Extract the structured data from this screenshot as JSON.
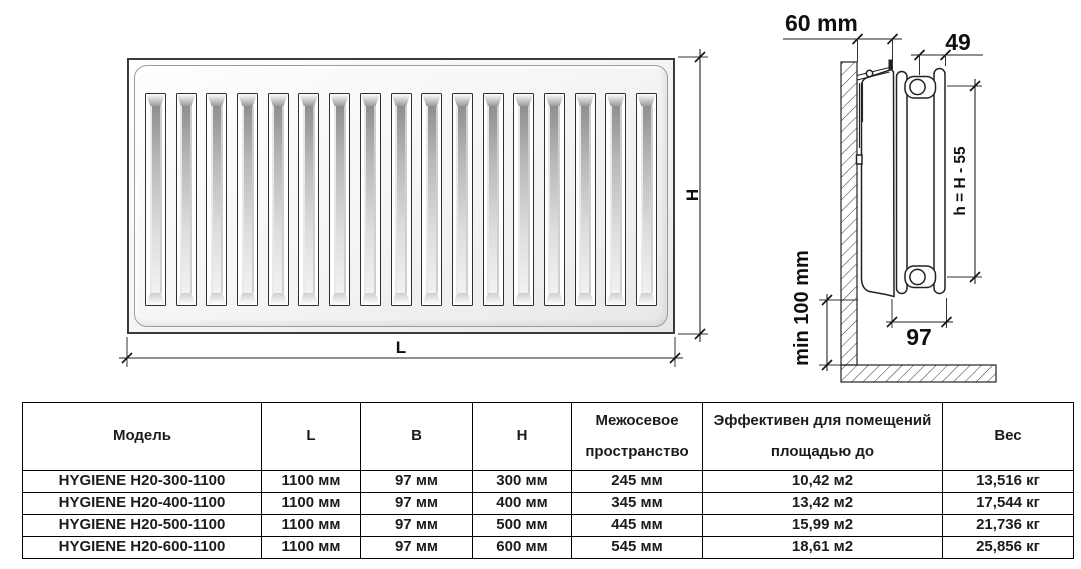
{
  "drawing": {
    "front_view": {
      "length_label": "L",
      "height_label": "H",
      "slat_count": 17
    },
    "side_view": {
      "wall_offset_label": "60 mm",
      "top_gap_label": "49",
      "panel_height_label": "h = H - 55",
      "floor_clearance_label": "min 100 mm",
      "depth_label": "97"
    }
  },
  "table": {
    "headers": [
      "Модель",
      "L",
      "B",
      "H",
      "Межосевое пространство",
      "Эффективен для помещений площадью до",
      "Вес"
    ],
    "rows": [
      [
        "HYGIENE H20-300-1100",
        "1100 мм",
        "97 мм",
        "300 мм",
        "245 мм",
        "10,42 м2",
        "13,516 кг"
      ],
      [
        "HYGIENE H20-400-1100",
        "1100 мм",
        "97 мм",
        "400 мм",
        "345 мм",
        "13,42 м2",
        "17,544 кг"
      ],
      [
        "HYGIENE H20-500-1100",
        "1100 мм",
        "97 мм",
        "500 мм",
        "445 мм",
        "15,99 м2",
        "21,736 кг"
      ],
      [
        "HYGIENE H20-600-1100",
        "1100 мм",
        "97 мм",
        "600 мм",
        "545 мм",
        "18,61 м2",
        "25,856 кг"
      ]
    ]
  }
}
